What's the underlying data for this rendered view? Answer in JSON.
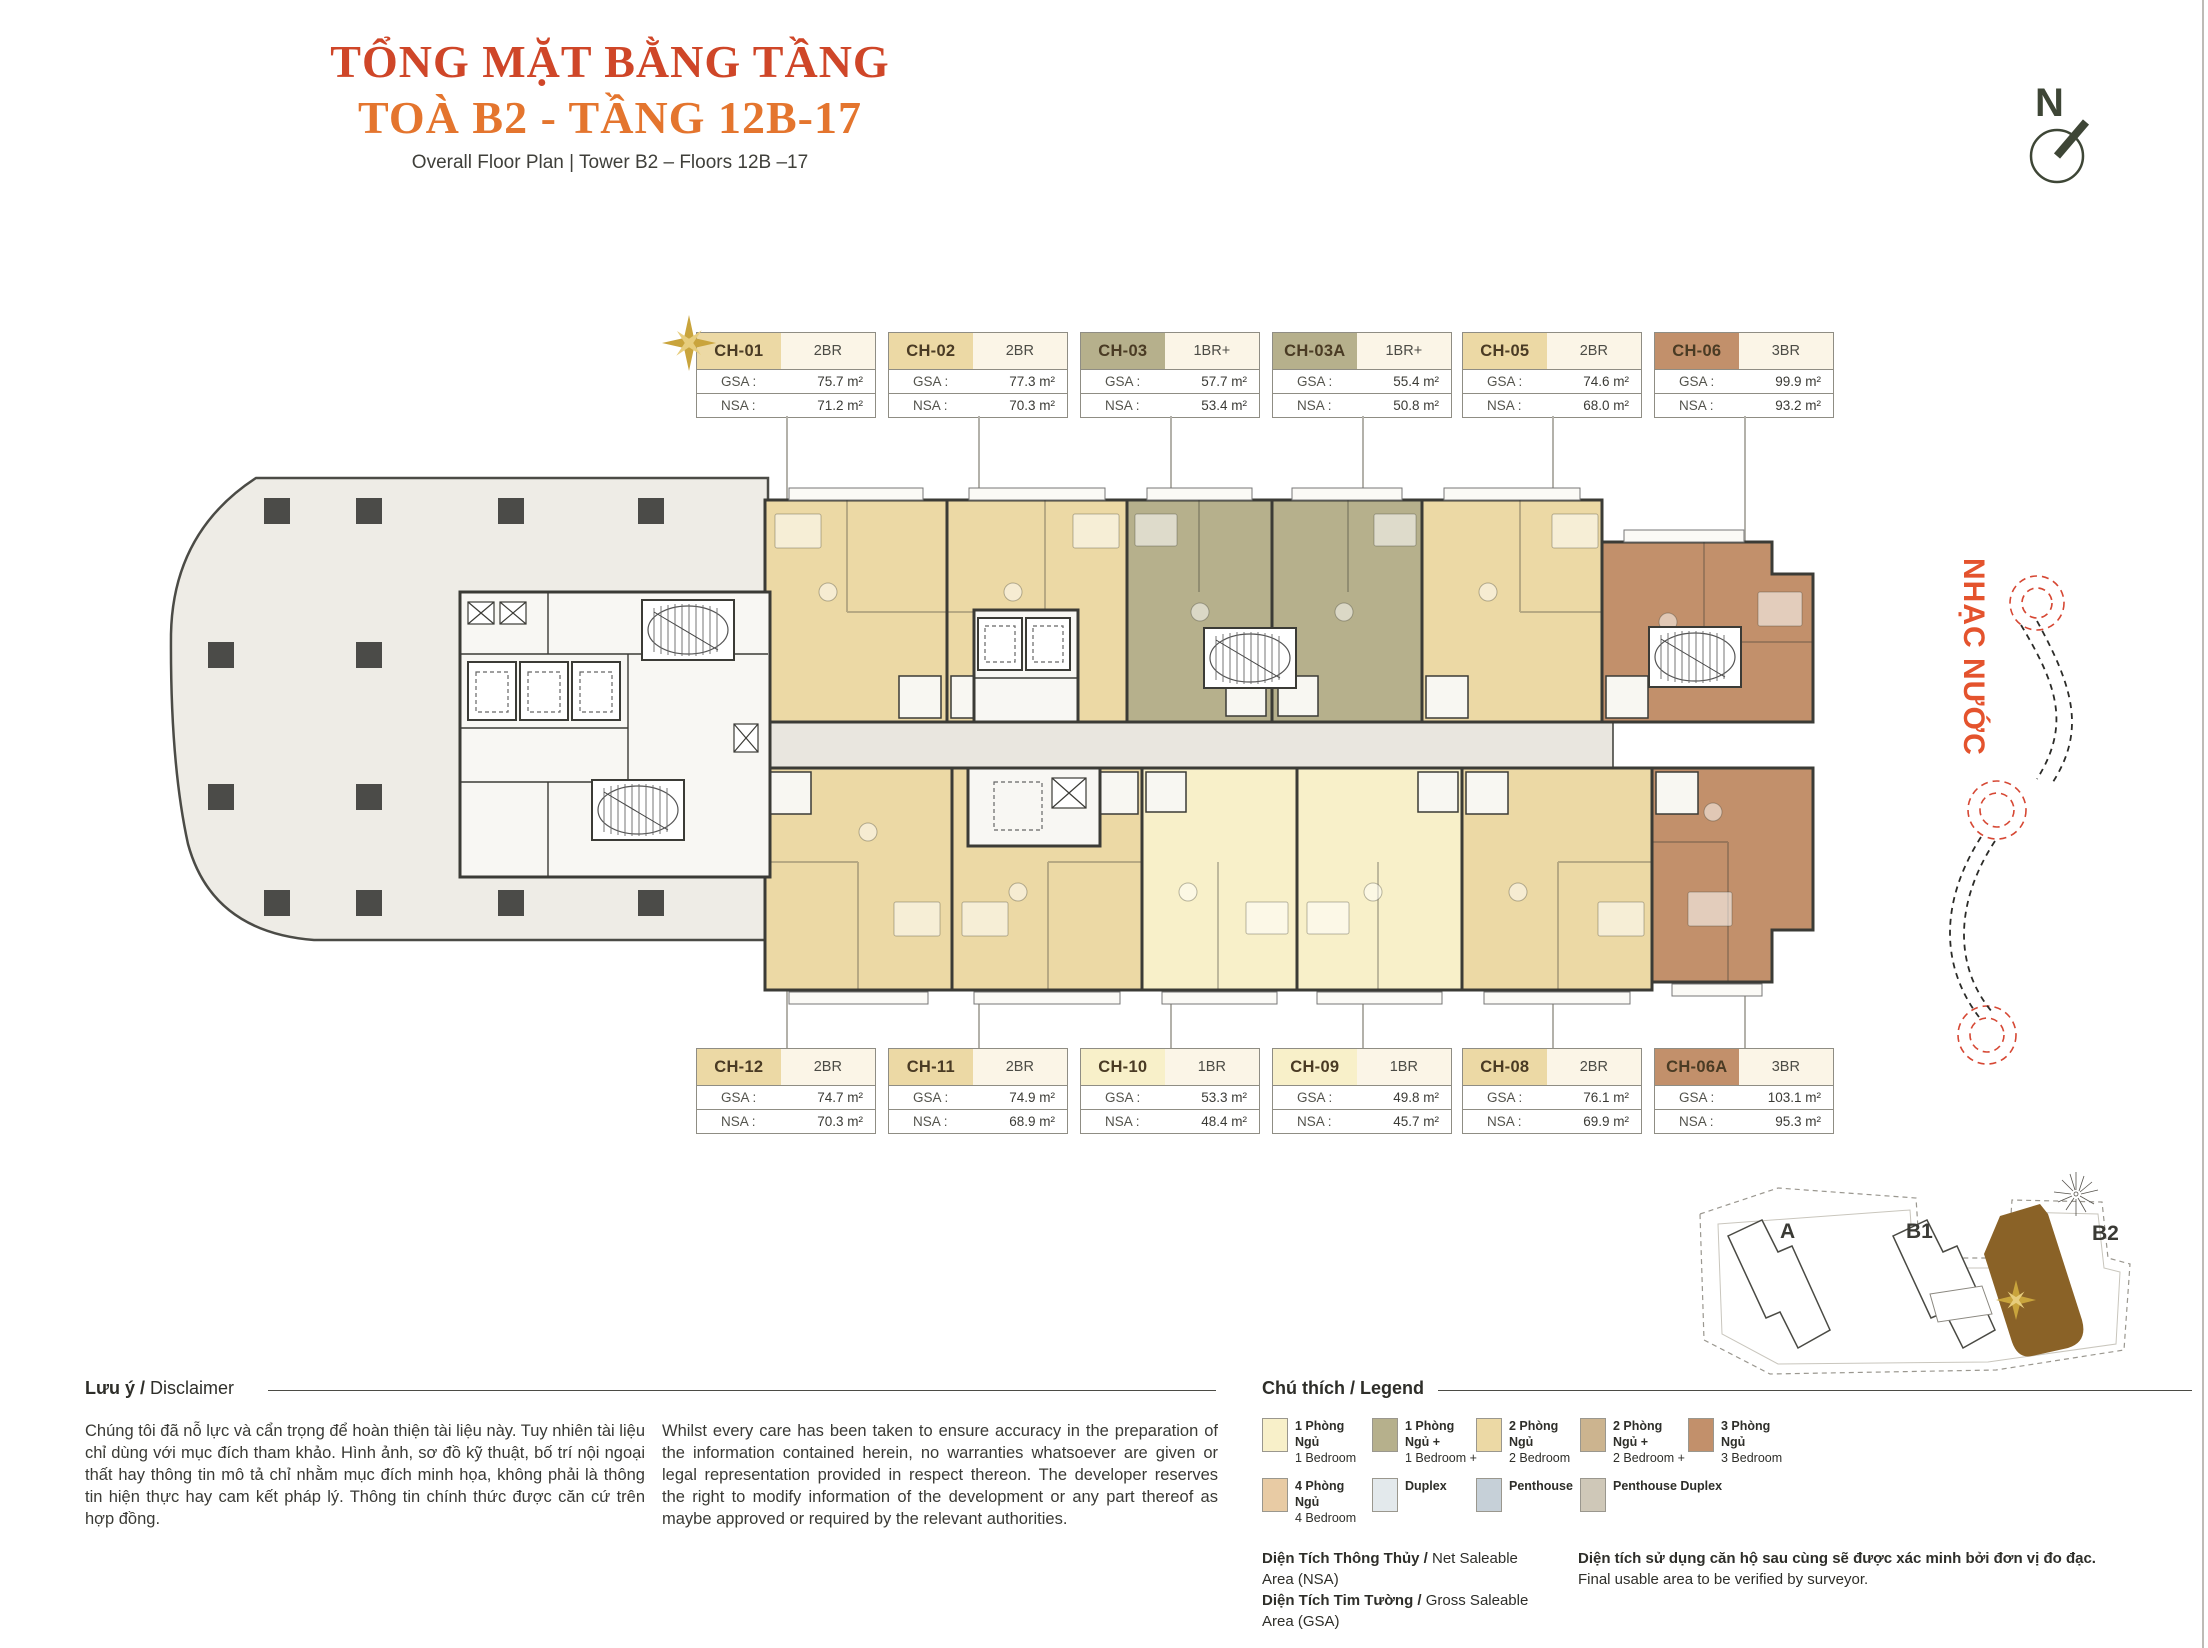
{
  "header": {
    "title_line1": "TỔNG MẶT BẰNG TẦNG",
    "title_line2": "TOÀ B2 - TẦNG 12B-17",
    "subtitle": "Overall Floor Plan  |  Tower B2 – Floors 12B –17",
    "north_label": "N"
  },
  "water_feature": {
    "label": "NHẠC NƯỚC"
  },
  "card_labels": {
    "gsa": "GSA :",
    "nsa": "NSA :"
  },
  "cards_top": [
    {
      "id": "CH-01",
      "type": "2BR",
      "gsa": "75.7 m²",
      "nsa": "71.2 m²",
      "category": "2br",
      "starred": true
    },
    {
      "id": "CH-02",
      "type": "2BR",
      "gsa": "77.3 m²",
      "nsa": "70.3 m²",
      "category": "2br"
    },
    {
      "id": "CH-03",
      "type": "1BR+",
      "gsa": "57.7 m²",
      "nsa": "53.4 m²",
      "category": "1br-plus"
    },
    {
      "id": "CH-03A",
      "type": "1BR+",
      "gsa": "55.4 m²",
      "nsa": "50.8 m²",
      "category": "1br-plus"
    },
    {
      "id": "CH-05",
      "type": "2BR",
      "gsa": "74.6 m²",
      "nsa": "68.0 m²",
      "category": "2br"
    },
    {
      "id": "CH-06",
      "type": "3BR",
      "gsa": "99.9 m²",
      "nsa": "93.2 m²",
      "category": "3br"
    }
  ],
  "cards_bottom": [
    {
      "id": "CH-12",
      "type": "2BR",
      "gsa": "74.7 m²",
      "nsa": "70.3 m²",
      "category": "2br"
    },
    {
      "id": "CH-11",
      "type": "2BR",
      "gsa": "74.9 m²",
      "nsa": "68.9 m²",
      "category": "2br"
    },
    {
      "id": "CH-10",
      "type": "1BR",
      "gsa": "53.3 m²",
      "nsa": "48.4 m²",
      "category": "1br"
    },
    {
      "id": "CH-09",
      "type": "1BR",
      "gsa": "49.8 m²",
      "nsa": "45.7 m²",
      "category": "1br"
    },
    {
      "id": "CH-08",
      "type": "2BR",
      "gsa": "76.1 m²",
      "nsa": "69.9 m²",
      "category": "2br"
    },
    {
      "id": "CH-06A",
      "type": "3BR",
      "gsa": "103.1 m²",
      "nsa": "95.3 m²",
      "category": "3br"
    }
  ],
  "site_map": {
    "tower_a": "A",
    "tower_b1": "B1",
    "tower_b2": "B2",
    "highlighted_tower": "B2"
  },
  "disclaimer": {
    "heading_vi": "Lưu ý /",
    "heading_en": " Disclaimer",
    "body_vi": "Chúng tôi đã nỗ lực và cẩn trọng để hoàn thiện tài liệu này. Tuy nhiên tài liệu chỉ dùng với mục đích tham khảo. Hình ảnh, sơ đồ kỹ thuật, bố trí nội ngoại thất hay thông tin mô tả chỉ nhằm mục đích minh họa, không phải là thông tin hiện thực hay cam kết pháp lý. Thông tin chính thức được căn cứ trên hợp đồng.",
    "body_en": "Whilst every care has been taken to ensure accuracy in the preparation of the information contained herein, no warranties whatsoever are given or legal representation provided in respect thereon. The developer reserves the right to modify information of the development or any part thereof as maybe approved or required by the relevant authorities."
  },
  "legend": {
    "heading_vi": "Chú thích /",
    "heading_en": " Legend",
    "items": [
      {
        "vi": "1 Phòng Ngủ",
        "en": "1 Bedroom",
        "color": "#F8F0C9"
      },
      {
        "vi": "1 Phòng Ngủ +",
        "en": "1 Bedroom +",
        "color": "#B6B08C"
      },
      {
        "vi": "2 Phòng Ngủ",
        "en": "2 Bedroom",
        "color": "#ECD9A5"
      },
      {
        "vi": "2 Phòng Ngủ +",
        "en": "2 Bedroom +",
        "color": "#CCB48F"
      },
      {
        "vi": "3 Phòng Ngủ",
        "en": "3 Bedroom",
        "color": "#C2906B"
      },
      {
        "vi": "4 Phòng Ngủ",
        "en": "4 Bedroom",
        "color": "#E8CBA4"
      },
      {
        "vi": "Duplex",
        "en": "",
        "color": "#E3E9EC"
      },
      {
        "vi": "Penthouse",
        "en": "",
        "color": "#C6D0D8"
      },
      {
        "vi": "Penthouse Duplex",
        "en": "",
        "color": "#CFC8B8"
      }
    ]
  },
  "area_notes": {
    "nsa_vi": "Diện Tích Thông Thủy /",
    "nsa_en": " Net Saleable Area (NSA)",
    "gsa_vi": "Diện Tích Tim Tường /",
    "gsa_en": " Gross Saleable Area (GSA)",
    "note_vi": "Diện tích sử dụng căn hộ sau cùng sẽ được xác minh bởi đơn vị đo đạc.",
    "note_en": "Final usable area to be verified by surveyor."
  },
  "colors": {
    "title_red": "#CF4628",
    "title_orange": "#E4752E",
    "accent_orange": "#E4532D",
    "wall": "#3B3B36",
    "podium": "#EEECE6",
    "corridor": "#E9E6DF",
    "unit_1br": "#F8F0C9",
    "unit_1br_plus": "#B6B08C",
    "unit_2br": "#ECD9A5",
    "unit_3br": "#C2906B",
    "tower_b2_fill": "#8A6227",
    "star_gold": "#C9A43C",
    "compass": "#3E4636"
  }
}
